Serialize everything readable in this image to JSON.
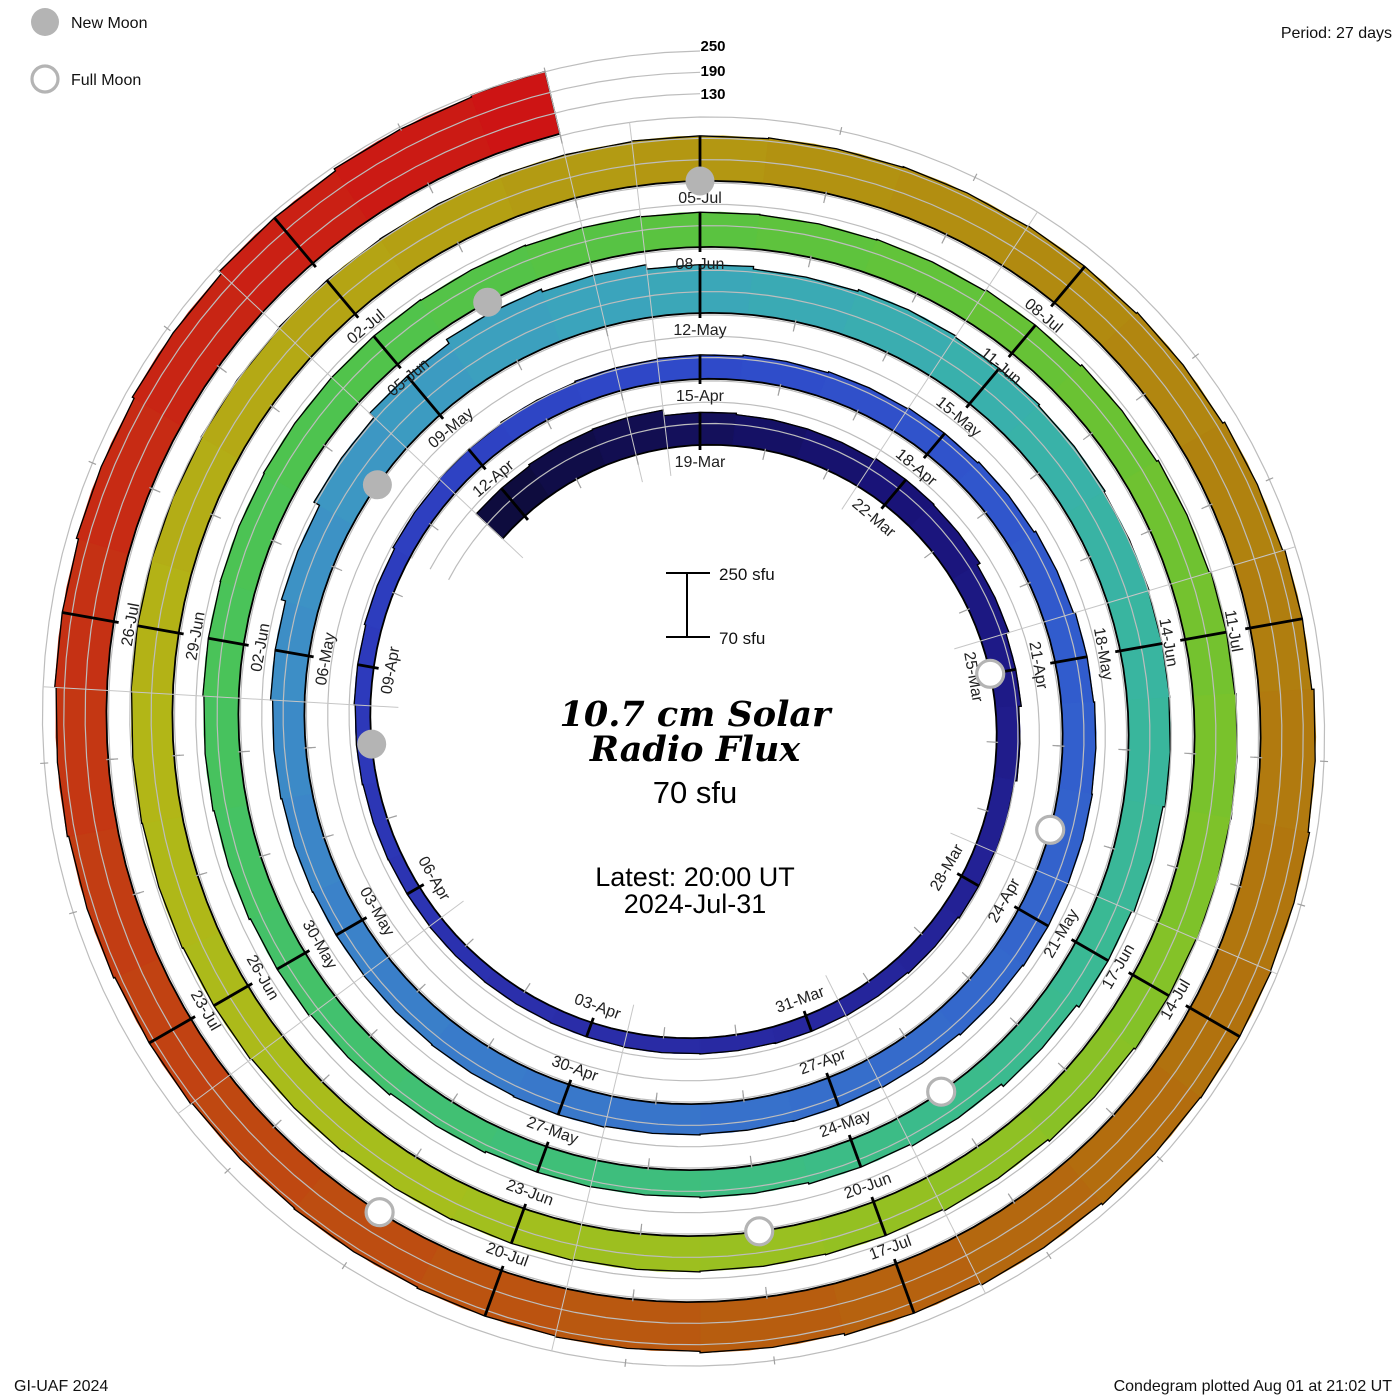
{
  "legend": {
    "new_moon": "New Moon",
    "full_moon": "Full Moon"
  },
  "header": {
    "period": "Period: 27 days"
  },
  "footer": {
    "left": "GI-UAF 2024",
    "right": "Condegram plotted Aug 01 at 21:02 UT"
  },
  "center": {
    "title_line1": "10.7 cm Solar",
    "title_line2": "Radio Flux",
    "latest_value": "70 sfu",
    "latest_label": "Latest: 20:00 UT",
    "latest_date": "2024-Jul-31"
  },
  "scale_bar": {
    "top": "250 sfu",
    "bottom": "70 sfu"
  },
  "axis_labels": [
    "250",
    "190",
    "130"
  ],
  "chart_data": {
    "type": "spiral_bar",
    "title": "10.7 cm Solar Radio Flux condegram",
    "period_days": 27,
    "start_date": "2024-03-16",
    "end_date": "2024-07-31",
    "flux_base": 70,
    "flux_gridlines": [
      130,
      190,
      250
    ],
    "flux_max": 250,
    "date_labels": [
      "19-Mar",
      "22-Mar",
      "25-Mar",
      "28-Mar",
      "31-Mar",
      "03-Apr",
      "06-Apr",
      "09-Apr",
      "12-Apr",
      "15-Apr",
      "18-Apr",
      "21-Apr",
      "24-Apr",
      "27-Apr",
      "30-Apr",
      "03-May",
      "06-May",
      "09-May",
      "12-May",
      "15-May",
      "18-May",
      "21-May",
      "24-May",
      "27-May",
      "30-May",
      "02-Jun",
      "05-Jun",
      "08-Jun",
      "11-Jun",
      "14-Jun",
      "17-Jun",
      "20-Jun",
      "23-Jun",
      "26-Jun",
      "29-Jun",
      "02-Jul",
      "05-Jul",
      "08-Jul",
      "11-Jul",
      "14-Jul",
      "17-Jul",
      "20-Jul",
      "23-Jul",
      "26-Jul"
    ],
    "daily_flux": [
      172,
      176,
      178,
      162,
      158,
      158,
      163,
      161,
      152,
      143,
      136,
      130,
      126,
      122,
      119,
      117,
      115,
      114,
      113,
      112,
      111,
      110,
      111,
      113,
      116,
      120,
      125,
      130,
      133,
      136,
      138,
      141,
      144,
      147,
      151,
      156,
      161,
      164,
      166,
      166,
      163,
      159,
      156,
      155,
      157,
      160,
      158,
      156,
      155,
      157,
      160,
      166,
      178,
      196,
      213,
      226,
      218,
      206,
      199,
      204,
      200,
      196,
      192,
      190,
      188,
      182,
      175,
      166,
      158,
      152,
      148,
      146,
      147,
      151,
      156,
      161,
      165,
      168,
      171,
      172,
      174,
      174,
      172,
      170,
      168,
      167,
      169,
      173,
      178,
      183,
      188,
      191,
      190,
      187,
      182,
      176,
      171,
      169,
      171,
      174,
      176,
      178,
      181,
      184,
      186,
      188,
      189,
      191,
      193,
      194,
      195,
      197,
      199,
      201,
      203,
      207,
      213,
      219,
      225,
      229,
      231,
      229,
      224,
      218,
      213,
      209,
      206,
      203,
      201,
      205,
      209,
      213,
      217,
      223,
      229,
      237,
      244,
      250
    ],
    "new_moon_day_indices": [
      23,
      53,
      82,
      111
    ],
    "full_moon_day_indices": [
      9,
      38,
      68,
      97,
      127
    ],
    "colormap": [
      [
        0,
        "#0e0c3e"
      ],
      [
        6,
        "#191378"
      ],
      [
        12,
        "#232195"
      ],
      [
        18,
        "#2a2da8"
      ],
      [
        24,
        "#2d3abc"
      ],
      [
        30,
        "#2f4ac9"
      ],
      [
        36,
        "#315ccd"
      ],
      [
        42,
        "#366ecb"
      ],
      [
        48,
        "#3b82c9"
      ],
      [
        52,
        "#3d92c5"
      ],
      [
        56,
        "#3ba4bc"
      ],
      [
        60,
        "#39b0ac"
      ],
      [
        64,
        "#39b69c"
      ],
      [
        68,
        "#3bbb8b"
      ],
      [
        72,
        "#3fbf78"
      ],
      [
        76,
        "#45c263"
      ],
      [
        80,
        "#4ec34f"
      ],
      [
        84,
        "#5ac340"
      ],
      [
        88,
        "#6ac233"
      ],
      [
        92,
        "#7ec22a"
      ],
      [
        96,
        "#94c022"
      ],
      [
        100,
        "#a6be1c"
      ],
      [
        104,
        "#b2b617"
      ],
      [
        108,
        "#b4a414"
      ],
      [
        112,
        "#b29211"
      ],
      [
        116,
        "#b0820f"
      ],
      [
        120,
        "#b1720e"
      ],
      [
        124,
        "#b75d0f"
      ],
      [
        128,
        "#bf4811"
      ],
      [
        132,
        "#c53114"
      ],
      [
        137,
        "#cd1414"
      ]
    ],
    "colors": {
      "grid": "#bdbdbd",
      "radial_grid": "#c6c6c6",
      "minor_tick": "#a0a0a0",
      "baseline": "#000000",
      "moon_gray": "#b4b4b4",
      "text_red": "#ee3c3c",
      "label_text": "#212121"
    }
  }
}
